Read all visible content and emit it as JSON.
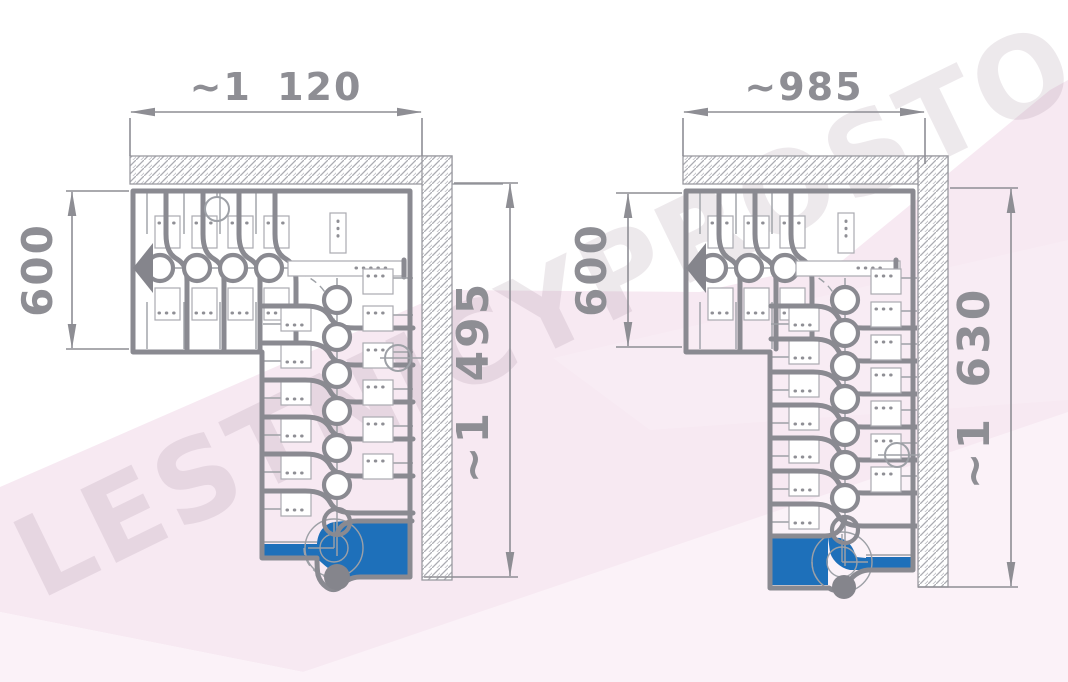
{
  "watermark": {
    "text": "LESTNICYPROSTO.RU"
  },
  "colors": {
    "accent_blue": "#1e70ba",
    "drawing_gray_thick": "#8a8a91",
    "drawing_gray_thin": "#9da0a6",
    "dimension_gray": "#8e8e94",
    "wall_hatch_gray": "#abacb2",
    "background_pink_band": "#f7e9f2",
    "background_pink_light": "#fbf2f8"
  },
  "diagrams": [
    {
      "name": "left-staircase-plan",
      "dim_width_top": "~1 120",
      "dim_depth_left": "600",
      "dim_length_right": "~1 495",
      "straight_modules": 4,
      "descending_modules": 7,
      "landing_color": "#1e70ba"
    },
    {
      "name": "right-staircase-plan",
      "dim_width_top": "~985",
      "dim_depth_left": "600",
      "dim_length_right": "~1 630",
      "straight_modules": 3,
      "descending_modules": 8,
      "landing_color": "#1e70ba"
    }
  ]
}
